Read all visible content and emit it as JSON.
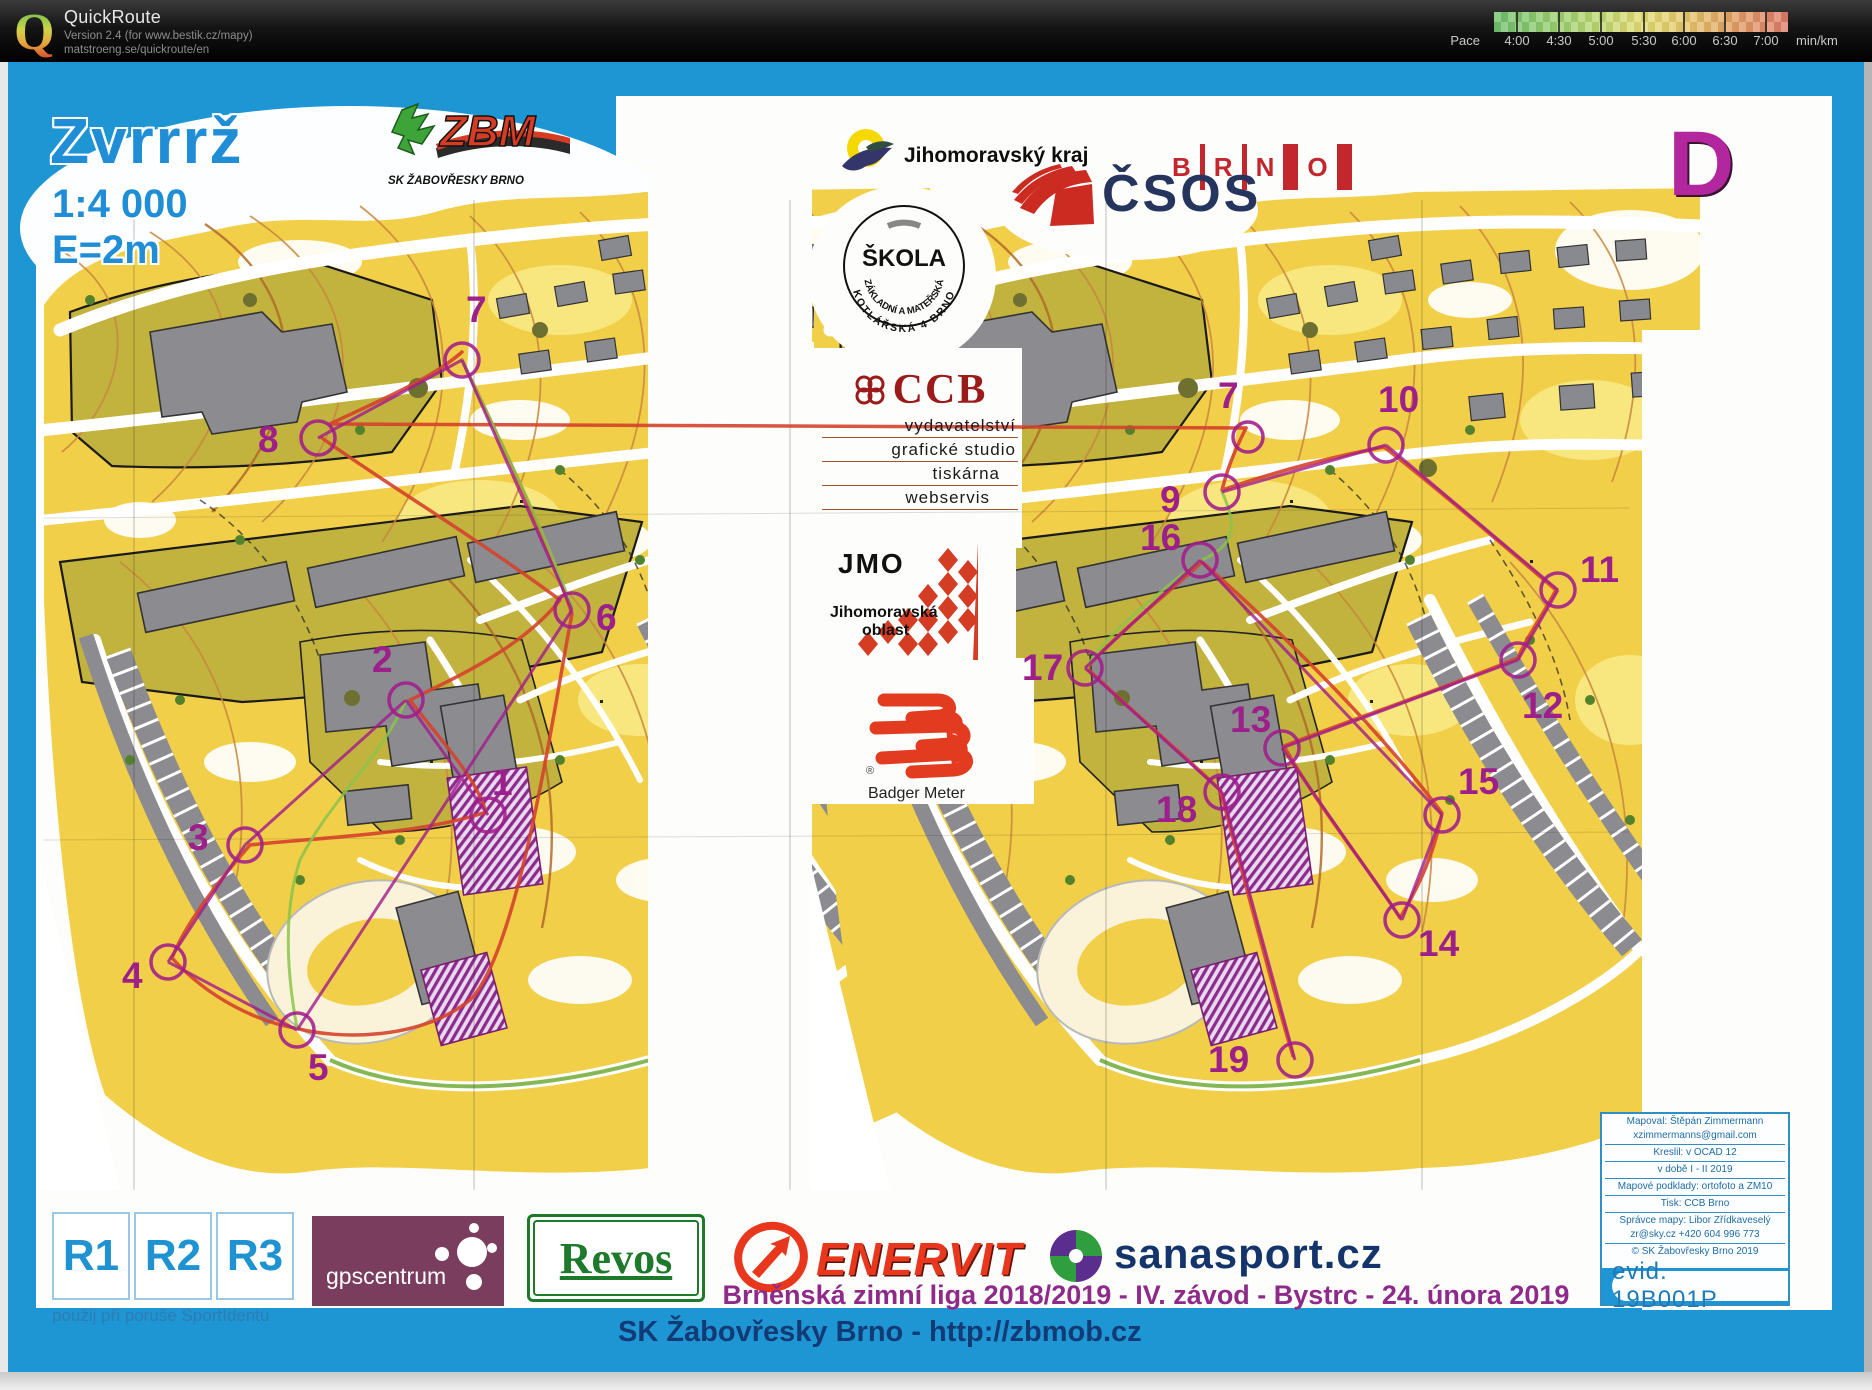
{
  "header": {
    "app_name": "QuickRoute",
    "logo_letter": "Q",
    "version_line": "Version 2.4  (for www.bestik.cz/mapy)",
    "url_line": "matstroeng.se/quickroute/en",
    "pace_label": "Pace",
    "pace_ticks": [
      "4:00",
      "4:30",
      "5:00",
      "5:30",
      "6:00",
      "6:30",
      "7:00"
    ],
    "pace_unit": "min/km"
  },
  "map_sheet": {
    "title": "Zvrrrž",
    "scale": "1:4 000",
    "equidistance": "E=2m",
    "course_letter": "D",
    "right_extra_label": "7",
    "controls_left": [
      {
        "num": "1"
      },
      {
        "num": "2"
      },
      {
        "num": "3"
      },
      {
        "num": "4"
      },
      {
        "num": "5"
      },
      {
        "num": "6"
      },
      {
        "num": "7"
      },
      {
        "num": "8"
      }
    ],
    "controls_right": [
      {
        "num": "9"
      },
      {
        "num": "10"
      },
      {
        "num": "11"
      },
      {
        "num": "12"
      },
      {
        "num": "13"
      },
      {
        "num": "14"
      },
      {
        "num": "15"
      },
      {
        "num": "16"
      },
      {
        "num": "17"
      },
      {
        "num": "18"
      },
      {
        "num": "19"
      }
    ],
    "colors": {
      "frame_blue": "#1e96d3",
      "course_magenta": "#a21c8c",
      "route_red": "#d4432c",
      "map_yellow": "#f2cf48",
      "olive_green": "#c2b23e",
      "building_gray": "#8b8b90"
    }
  },
  "sponsors": {
    "zbm": {
      "name": "ZBM",
      "caption": "SK ŽABOVŘESKY BRNO"
    },
    "jmk": {
      "label": "Jihomoravský kraj"
    },
    "skola": {
      "center": "ŠKOLA",
      "ring_inner": "ZÁKLADNÍ A MATEŘSKÁ",
      "ring_outer": "KOTLÁŘSKÁ 4 BRNO"
    },
    "brno": {
      "letters": [
        "B",
        "R",
        "N",
        "O"
      ]
    },
    "csos": {
      "label": "ČSOS"
    },
    "ccb": {
      "label": "CCB",
      "lines": [
        "vydavatelství",
        "grafické studio",
        "tiskárna",
        "webservis"
      ]
    },
    "jmo": {
      "label": "JMO",
      "caption1": "Jihomoravská",
      "caption2": "oblast"
    },
    "badger": {
      "label": "Badger Meter",
      "reg": "®"
    },
    "r123": {
      "boxes": [
        "R1",
        "R2",
        "R3"
      ],
      "caption": "použij při poruše SportIdentu"
    },
    "gpscentrum": {
      "label": "gpscentrum"
    },
    "revos": {
      "label": "Revos"
    },
    "enervit": {
      "label": "ENERVIT"
    },
    "sanasport": {
      "label": "sanasport.cz"
    }
  },
  "footer": {
    "event_line": "Brněnská zimní liga 2018/2019 - IV. závod - Bystrc - 24. února 2019",
    "club_line": "SK Žabovřesky Brno - http://zbmob.cz"
  },
  "credits": {
    "lines": [
      "Mapoval: Štěpán Zimmermann",
      "xzimmermanns@gmail.com",
      "Kreslil: v OCAD 12",
      "v době I - II 2019",
      "Mapové podklady: ortofoto a ZM10",
      "Tisk: CCB Brno",
      "Správce mapy: Libor Zřídkaveselý",
      "zr@sky.cz  +420 604 996 773",
      "© SK Žabovřesky Brno 2019"
    ],
    "evid": "evid. 19B001P"
  }
}
